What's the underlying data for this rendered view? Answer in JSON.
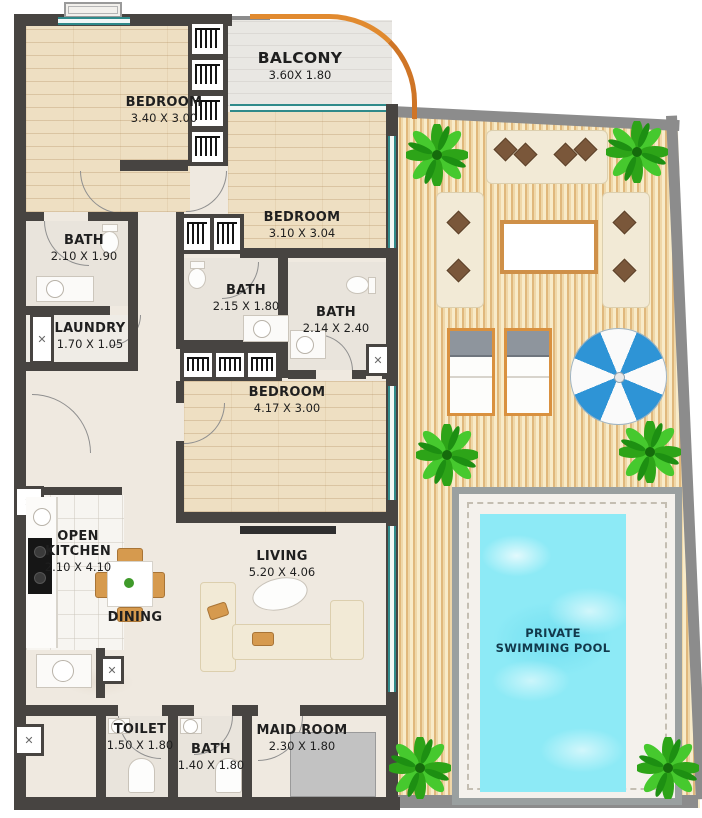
{
  "rooms": {
    "bedroom1": {
      "label": "BEDROOM",
      "dims": "3.40 X 3.00"
    },
    "balcony": {
      "label": "BALCONY",
      "dims": "3.60X 1.80"
    },
    "bedroom2": {
      "label": "BEDROOM",
      "dims": "3.10 X 3.04"
    },
    "bath1": {
      "label": "BATH",
      "dims": "2.10 X 1.90"
    },
    "laundry": {
      "label": "LAUNDRY",
      "dims": "1.70 X 1.05"
    },
    "bath2": {
      "label": "BATH",
      "dims": "2.15 X 1.80"
    },
    "bath3": {
      "label": "BATH",
      "dims": "2.14 X 2.40"
    },
    "bedroom3": {
      "label": "BEDROOM",
      "dims": "4.17 X 3.00"
    },
    "open_kitchen": {
      "label": "OPEN KITCHEN",
      "dims": "2.10 X 4.10"
    },
    "dining": {
      "label": "DINING"
    },
    "living": {
      "label": "LIVING",
      "dims": "5.20 X 4.06"
    },
    "toilet": {
      "label": "TOILET",
      "dims": "1.50 X 1.80"
    },
    "bath4": {
      "label": "BATH",
      "dims": "1.40 X 1.80"
    },
    "maid_room": {
      "label": "MAID ROOM",
      "dims": "2.30 X 1.80"
    },
    "pool": {
      "label": "PRIVATE SWIMMING POOL"
    }
  },
  "icons": {
    "shaft_x": "✕"
  },
  "colors": {
    "wall": "#474441",
    "terrace_wall": "#8c8c8c",
    "deck_wood": "#efd7a8",
    "pool_water": "#8deaf6",
    "glass": "#2f8a8a",
    "palm_green": "#35b31f",
    "umbrella_blue": "#2e94d6",
    "balcony_arc": "#e18a2f",
    "bedroom_wood": "#eedfc2"
  }
}
